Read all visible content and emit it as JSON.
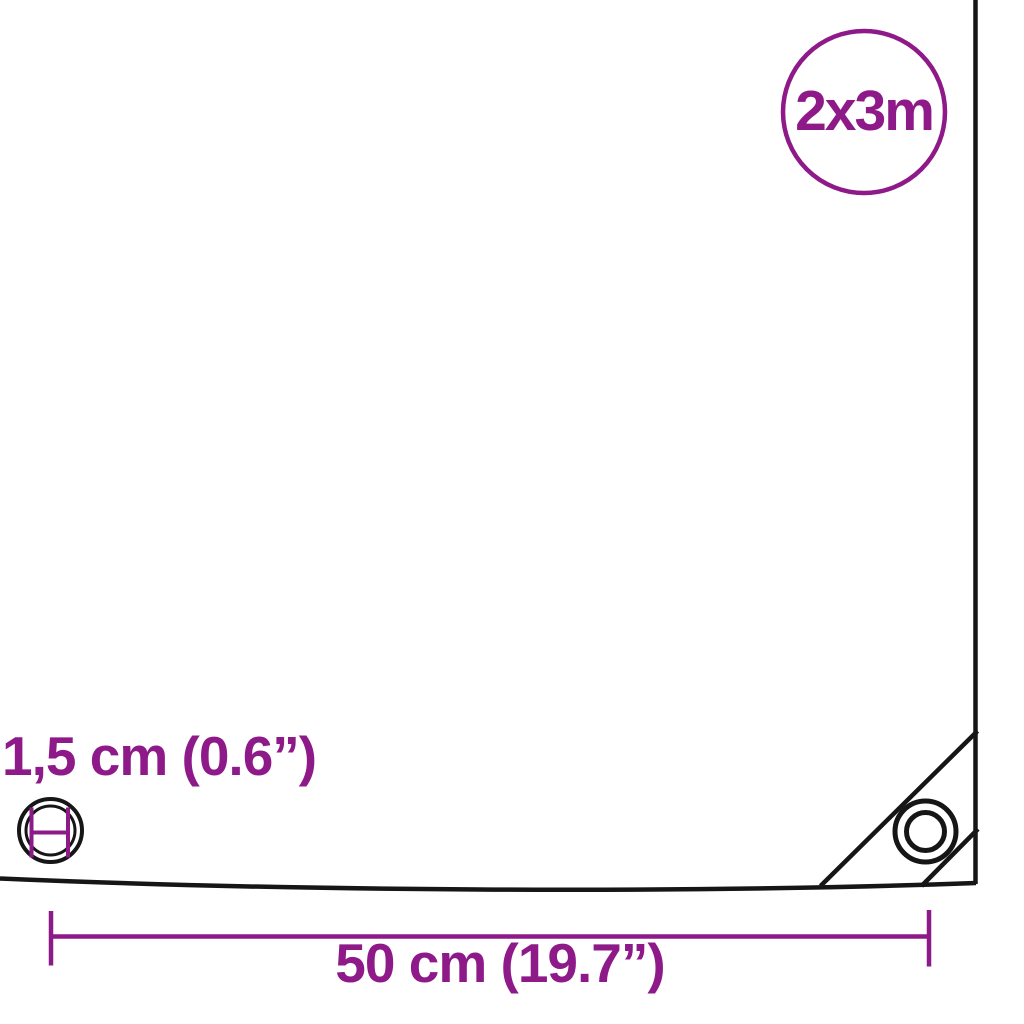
{
  "colors": {
    "accent_purple": "#8E1A89",
    "line_black": "#161616",
    "background": "#FFFFFF"
  },
  "badge": {
    "label": "2x3m"
  },
  "eyelet_dimension": {
    "label": "1,5 cm (0.6”)"
  },
  "width_dimension": {
    "label": "50 cm (19.7”)"
  },
  "icons": {
    "left_eyelet": "concentric-circles-eyelet",
    "corner_eyelet": "concentric-circles-eyelet",
    "diameter_gauge": "measurement-ticks-i-beam",
    "size_badge": "circle-outline"
  }
}
